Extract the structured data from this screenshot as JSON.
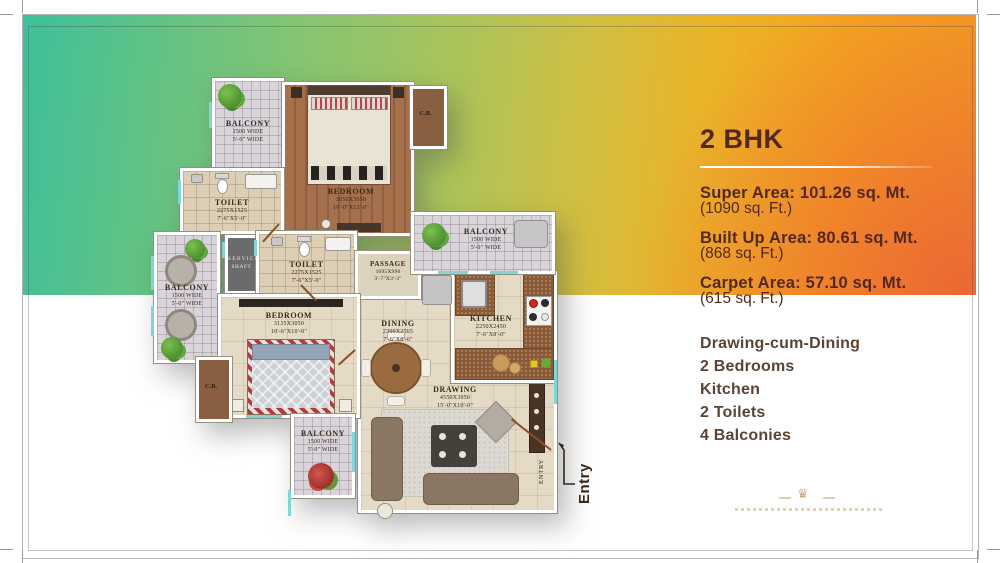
{
  "panel": {
    "title": "2 BHK",
    "areas": [
      {
        "head": "Super Area: 101.26 sq. Mt.",
        "sub": "(1090 sq. Ft.)"
      },
      {
        "head": "Built Up Area: 80.61 sq. Mt.",
        "sub": "(868 sq. Ft.)"
      },
      {
        "head": "Carpet Area: 57.10 sq. Mt.",
        "sub": "(615 sq. Ft.)"
      }
    ],
    "features": [
      "Drawing-cum-Dining",
      "2 Bedrooms",
      "Kitchen",
      "2 Toilets",
      "4 Balconies"
    ]
  },
  "plan": {
    "rooms": {
      "balcony_tl": {
        "name": "BALCONY",
        "dim_mm": "1500 WIDE",
        "dim_ft": "5'-0\" WIDE"
      },
      "bedroom1": {
        "name": "BEDROOM",
        "dim_mm": "3050X3650",
        "dim_ft": "10'-0\"X12'-0\""
      },
      "cb1": {
        "name": "C.B."
      },
      "toilet1": {
        "name": "TOILET",
        "dim_mm": "2275X1525",
        "dim_ft": "7'-6\"X5'-0\""
      },
      "balcony_left": {
        "name": "BALCONY",
        "dim_mm": "1500 WIDE",
        "dim_ft": "5'-0\" WIDE"
      },
      "service_shaft": {
        "line1": "SERVICE",
        "line2": "SHAFT"
      },
      "toilet2": {
        "name": "TOILET",
        "dim_mm": "2275X1525",
        "dim_ft": "7'-6\"X5'-0\""
      },
      "passage": {
        "name": "PASSAGE",
        "dim_mm": "1095X990",
        "dim_ft": "3'-7\"X3'-3\""
      },
      "balcony_tr": {
        "name": "BALCONY",
        "dim_mm": "1500 WIDE",
        "dim_ft": "5'-0\" WIDE"
      },
      "bedroom2": {
        "name": "BEDROOM",
        "dim_mm": "3135X3050",
        "dim_ft": "10'-6\"X10'-0\""
      },
      "cb2": {
        "name": "C.B."
      },
      "dining": {
        "name": "DINING",
        "dim_mm": "2300X2565",
        "dim_ft": "7'-6\"X8'-6\""
      },
      "kitchen": {
        "name": "KITCHEN",
        "dim_mm": "2250X2450",
        "dim_ft": "7'-6\"X8'-0\""
      },
      "drawing": {
        "name": "DRAWING",
        "dim_mm": "4550X3050",
        "dim_ft": "15'-0\"X10'-0\""
      },
      "balcony_bottom": {
        "name": "BALCONY",
        "dim_mm": "1500 WIDE",
        "dim_ft": "5'-0\" WIDE"
      }
    },
    "entry": {
      "outer_label": "Entry",
      "inner_label": "ENTRY"
    }
  },
  "colors": {
    "gradient_left": "#3ec09b",
    "gradient_mid": "#a9c45c",
    "gradient_right": "#f4a41f",
    "gradient_corner": "#e9543a",
    "panel_text": "#54281e",
    "features_text": "#5b4435",
    "watermark_gold": "#b3914f"
  }
}
